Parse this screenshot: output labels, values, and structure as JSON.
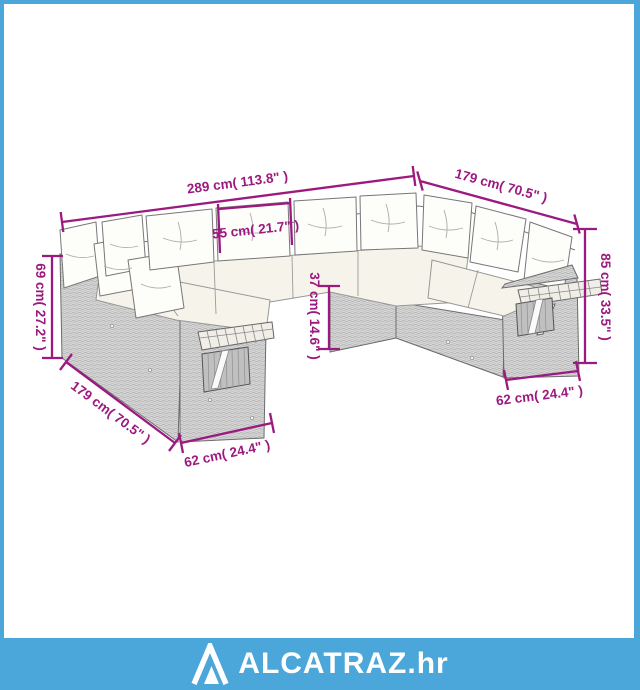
{
  "diagram": {
    "illustration": "u-shaped-poly-rattan-garden-sofa-set-with-cushions-and-fold-out-side-shelves",
    "dimensions": {
      "total_width": "289 cm( 113.8\" )",
      "right_wing_depth": "179 cm( 70.5\" )",
      "seat_width": "55 cm( 21.7\" )",
      "left_back_height": "69 cm( 27.2\" )",
      "seat_height": "37 cm( 14.6\" )",
      "total_height": "85 cm( 33.5\" )",
      "left_wing_depth": "179 cm( 70.5\" )",
      "left_end_width": "62 cm( 24.4\" )",
      "right_end_width": "62 cm( 24.4\" )"
    },
    "colors": {
      "dimension_accent": "#9C1A7F",
      "frame_blue": "#4BA6D9",
      "rattan_gray": "#D7D7D7",
      "cushion_white": "#FDFDFA",
      "seat_cream": "#F6F4EA"
    }
  },
  "footer": {
    "brand": "ALCATRAZ.hr",
    "logo_icon": "mountain-triangle-icon"
  }
}
